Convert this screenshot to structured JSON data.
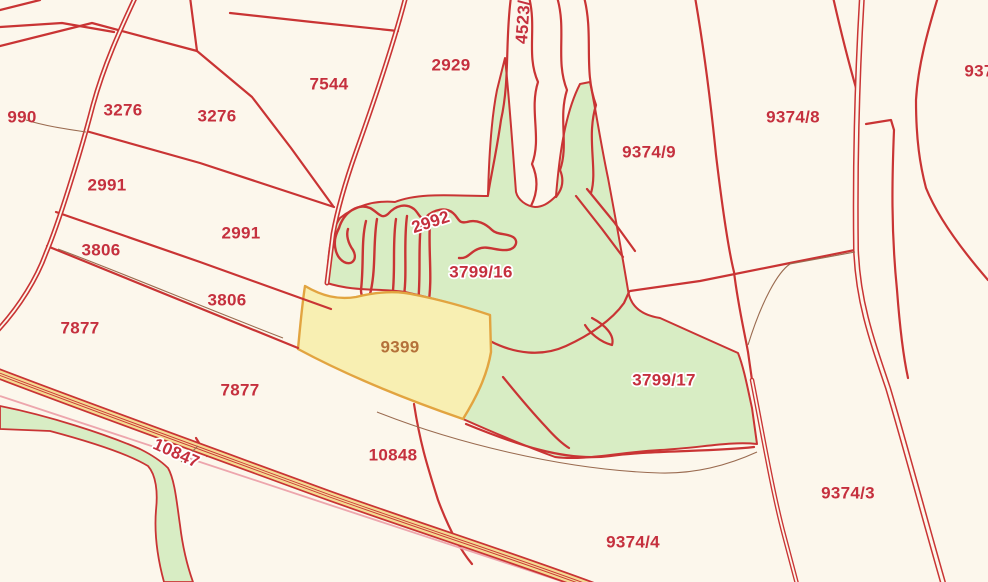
{
  "map": {
    "description": "Cadastral parcel map view",
    "labels": [
      {
        "text": "990",
        "x": 22,
        "y": 118
      },
      {
        "text": "3276",
        "x": 123,
        "y": 111
      },
      {
        "text": "3276",
        "x": 217,
        "y": 117
      },
      {
        "text": "7544",
        "x": 329,
        "y": 85
      },
      {
        "text": "2929",
        "x": 451,
        "y": 66
      },
      {
        "text": "4523/",
        "x": 524,
        "y": 22,
        "rot": -86
      },
      {
        "text": "9374/9",
        "x": 649,
        "y": 153
      },
      {
        "text": "9374/8",
        "x": 793,
        "y": 118
      },
      {
        "text": "937",
        "x": 979,
        "y": 72
      },
      {
        "text": "2991",
        "x": 107,
        "y": 186
      },
      {
        "text": "2991",
        "x": 241,
        "y": 234
      },
      {
        "text": "3806",
        "x": 101,
        "y": 251
      },
      {
        "text": "3806",
        "x": 227,
        "y": 301
      },
      {
        "text": "7877",
        "x": 80,
        "y": 329
      },
      {
        "text": "7877",
        "x": 240,
        "y": 391
      },
      {
        "text": "2992",
        "x": 431,
        "y": 223,
        "rot": -18,
        "halo": true
      },
      {
        "text": "3799/16",
        "x": 481,
        "y": 273,
        "halo": true
      },
      {
        "text": "9399",
        "x": 400,
        "y": 348,
        "color": "brown"
      },
      {
        "text": "3799/17",
        "x": 664,
        "y": 381,
        "halo": true
      },
      {
        "text": "10847",
        "x": 176,
        "y": 454,
        "rot": 24,
        "halo": true
      },
      {
        "text": "10848",
        "x": 393,
        "y": 456
      },
      {
        "text": "9374/4",
        "x": 633,
        "y": 543
      },
      {
        "text": "9374/3",
        "x": 848,
        "y": 494
      }
    ],
    "highlighted_parcel": "9399"
  },
  "colors": {
    "background": "#fcf7ec",
    "boundary_red": "#c93434",
    "label_red": "#c5303e",
    "forest_green": "#d8edc4",
    "highlight_fill": "#f8efb2",
    "highlight_border": "#e2a440",
    "road_fill": "#f4da93",
    "leader_brown": "#9a6b50",
    "pink_line": "#eda6ad",
    "label_brown": "#b4713a"
  }
}
